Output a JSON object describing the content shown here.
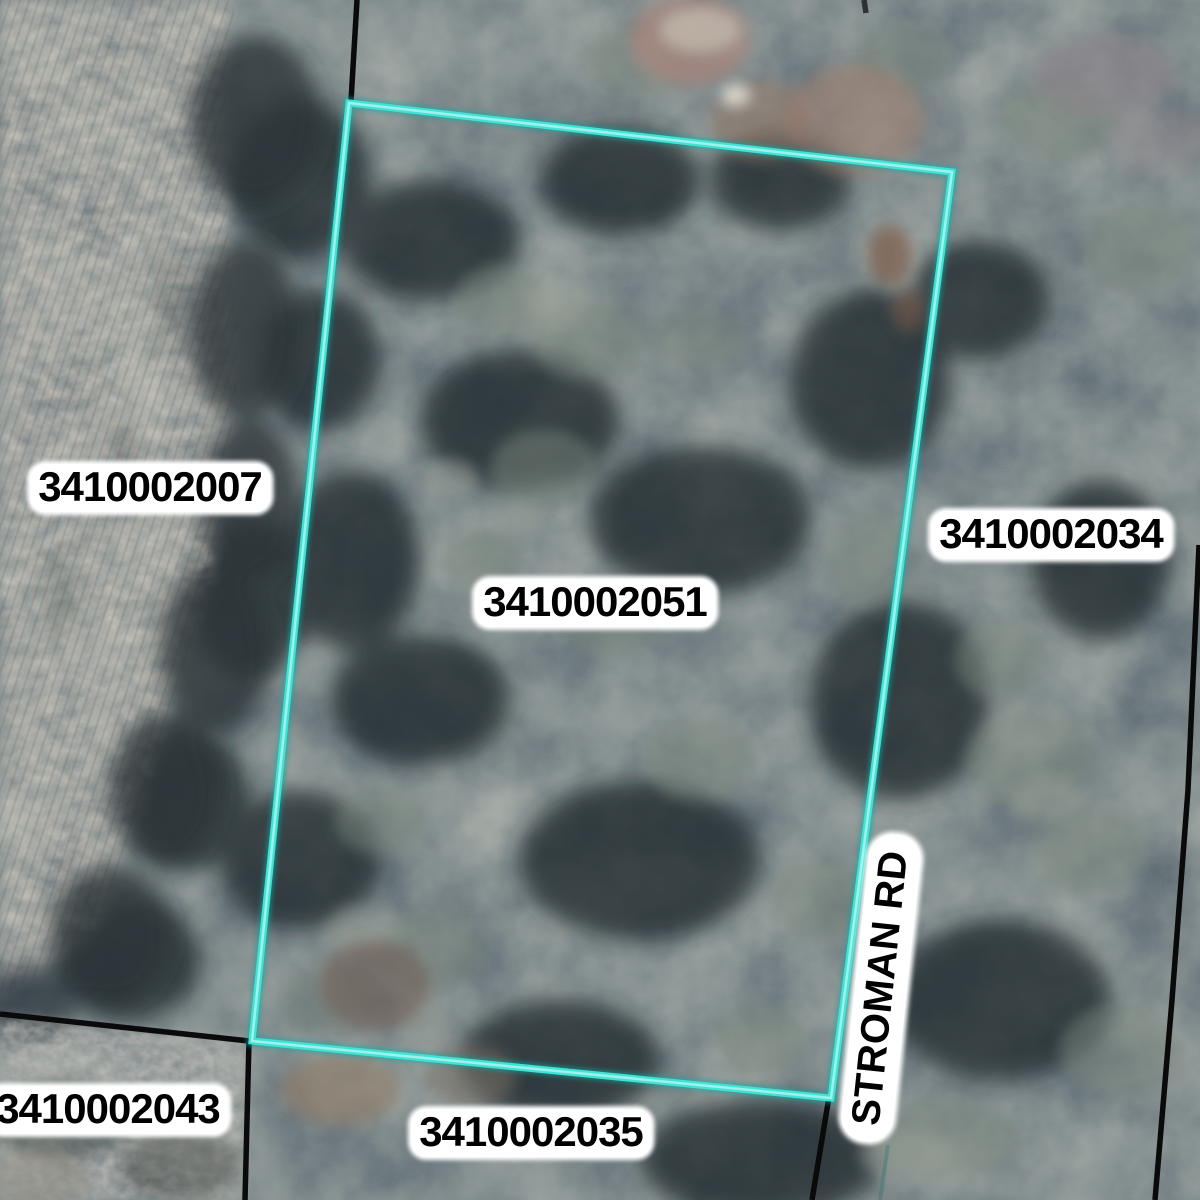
{
  "map_type": "gis-parcel-aerial-map",
  "parcels": {
    "west": {
      "id": "3410002007"
    },
    "selected": {
      "id": "3410002051",
      "highlighted": true
    },
    "east": {
      "id": "3410002034"
    },
    "southwest": {
      "id": "3410002043"
    },
    "south": {
      "id": "3410002035"
    }
  },
  "road": {
    "name": "STROMAN RD"
  },
  "colors": {
    "selected_outline": "#3fe3d6",
    "selected_outline_core": "#b0f5ee",
    "selected_outline_glow": "#0fa9a2",
    "boundary_line": "#0a0a0a",
    "label_text": "#000000",
    "label_halo": "#ffffff"
  }
}
